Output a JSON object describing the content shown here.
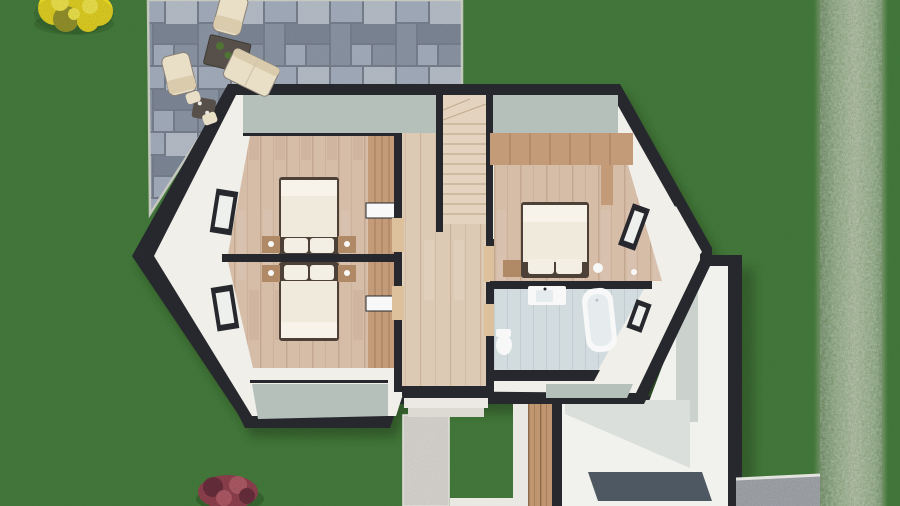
{
  "meta": {
    "description": "Top-down 3D architectural render of an upper-storey floor plan set in a garden with a stone patio, outdoor furniture, shrubs, a privacy hedge on the right and a paved entrance walk at the bottom",
    "width_px": 900,
    "height_px": 506,
    "visible_text": ""
  },
  "objects": {
    "garden": [
      "lawn",
      "stone-patio",
      "boxwood-hedge",
      "yellow-shrub",
      "red-shrub",
      "paved-walkway",
      "gravel-strip",
      "timber-screen-wall"
    ],
    "patio_furniture": [
      "lounge-chair",
      "lounge-chair",
      "outdoor-sofa",
      "coffee-table-with-plants",
      "bistro-table",
      "bistro-chairs"
    ],
    "floorplan_rooms": [
      "bedroom-top-left",
      "bedroom-bottom-left",
      "bedroom-right",
      "bathroom",
      "hallway-landing",
      "staircase",
      "entry-annex"
    ],
    "interior_fixtures": [
      "double-bed",
      "double-bed",
      "double-bed",
      "nightstands",
      "built-in-wardrobe",
      "washbasin",
      "bathtub",
      "toilet",
      "interior-doors",
      "roof-glazing-bands",
      "door-mat",
      "entry-steps",
      "windows"
    ]
  },
  "colors": {
    "grass": "#417c38",
    "shadow": "#17270f",
    "hedge_dark": "#5e8353",
    "hedge_mid": "#8cab7d",
    "hedge_light": "#aabf99",
    "paver_grout": "#6a7380",
    "paver_a": "#97a1b0",
    "paver_b": "#7e8897",
    "paver_c": "#a9b1bc",
    "paver_d": "#707a89",
    "patio_curb": "#c2c6bb",
    "wall": "#26282d",
    "eave_white": "#f1efe9",
    "glass_roof": "#b5c0bb",
    "wood_bedroom": "#d5bda8",
    "wood_streak": "#c3a78f",
    "wood_hall": "#ddcab4",
    "stair_wood": "#e4d4bf",
    "stair_line": "#c2ab90",
    "wardrobe": "#c39b79",
    "wardrobe_line": "#9e7758",
    "door_wood": "#dcc19c",
    "duvet": "#f0eadd",
    "duvet_fold": "#f7f3ea",
    "pillow": "#f4efe4",
    "bed_frame": "#4d4137",
    "nightstand": "#b08a67",
    "tile_floor": "#d2dcdf",
    "tile_line": "#c2cdd1",
    "fixture": "#f7f8f7",
    "tub_inner": "#e6ecee",
    "walkway": "#d9d5d0",
    "white_strip": "#eae8e2",
    "wood_fence": "#c09671",
    "wood_fence_line": "#8c6a49",
    "annex_floor": "#f1f1ee",
    "annex_wall_a": "#cbd2ce",
    "annex_wall_b": "#dadfdc",
    "mat": "#4e5862",
    "gravel": "#a8acb1",
    "cream": "#e9dfc6",
    "cream_dark": "#d9cbab",
    "table_dark": "#57504a",
    "plant_green": "#4f7334",
    "bush_yellow": "#e4d324",
    "bush_yellow_hi": "#f2e74e",
    "bush_yellow_dark": "#97952c",
    "bush_red": "#984553",
    "bush_red_dark": "#6f3140",
    "bush_red_hi": "#b75f6b"
  }
}
